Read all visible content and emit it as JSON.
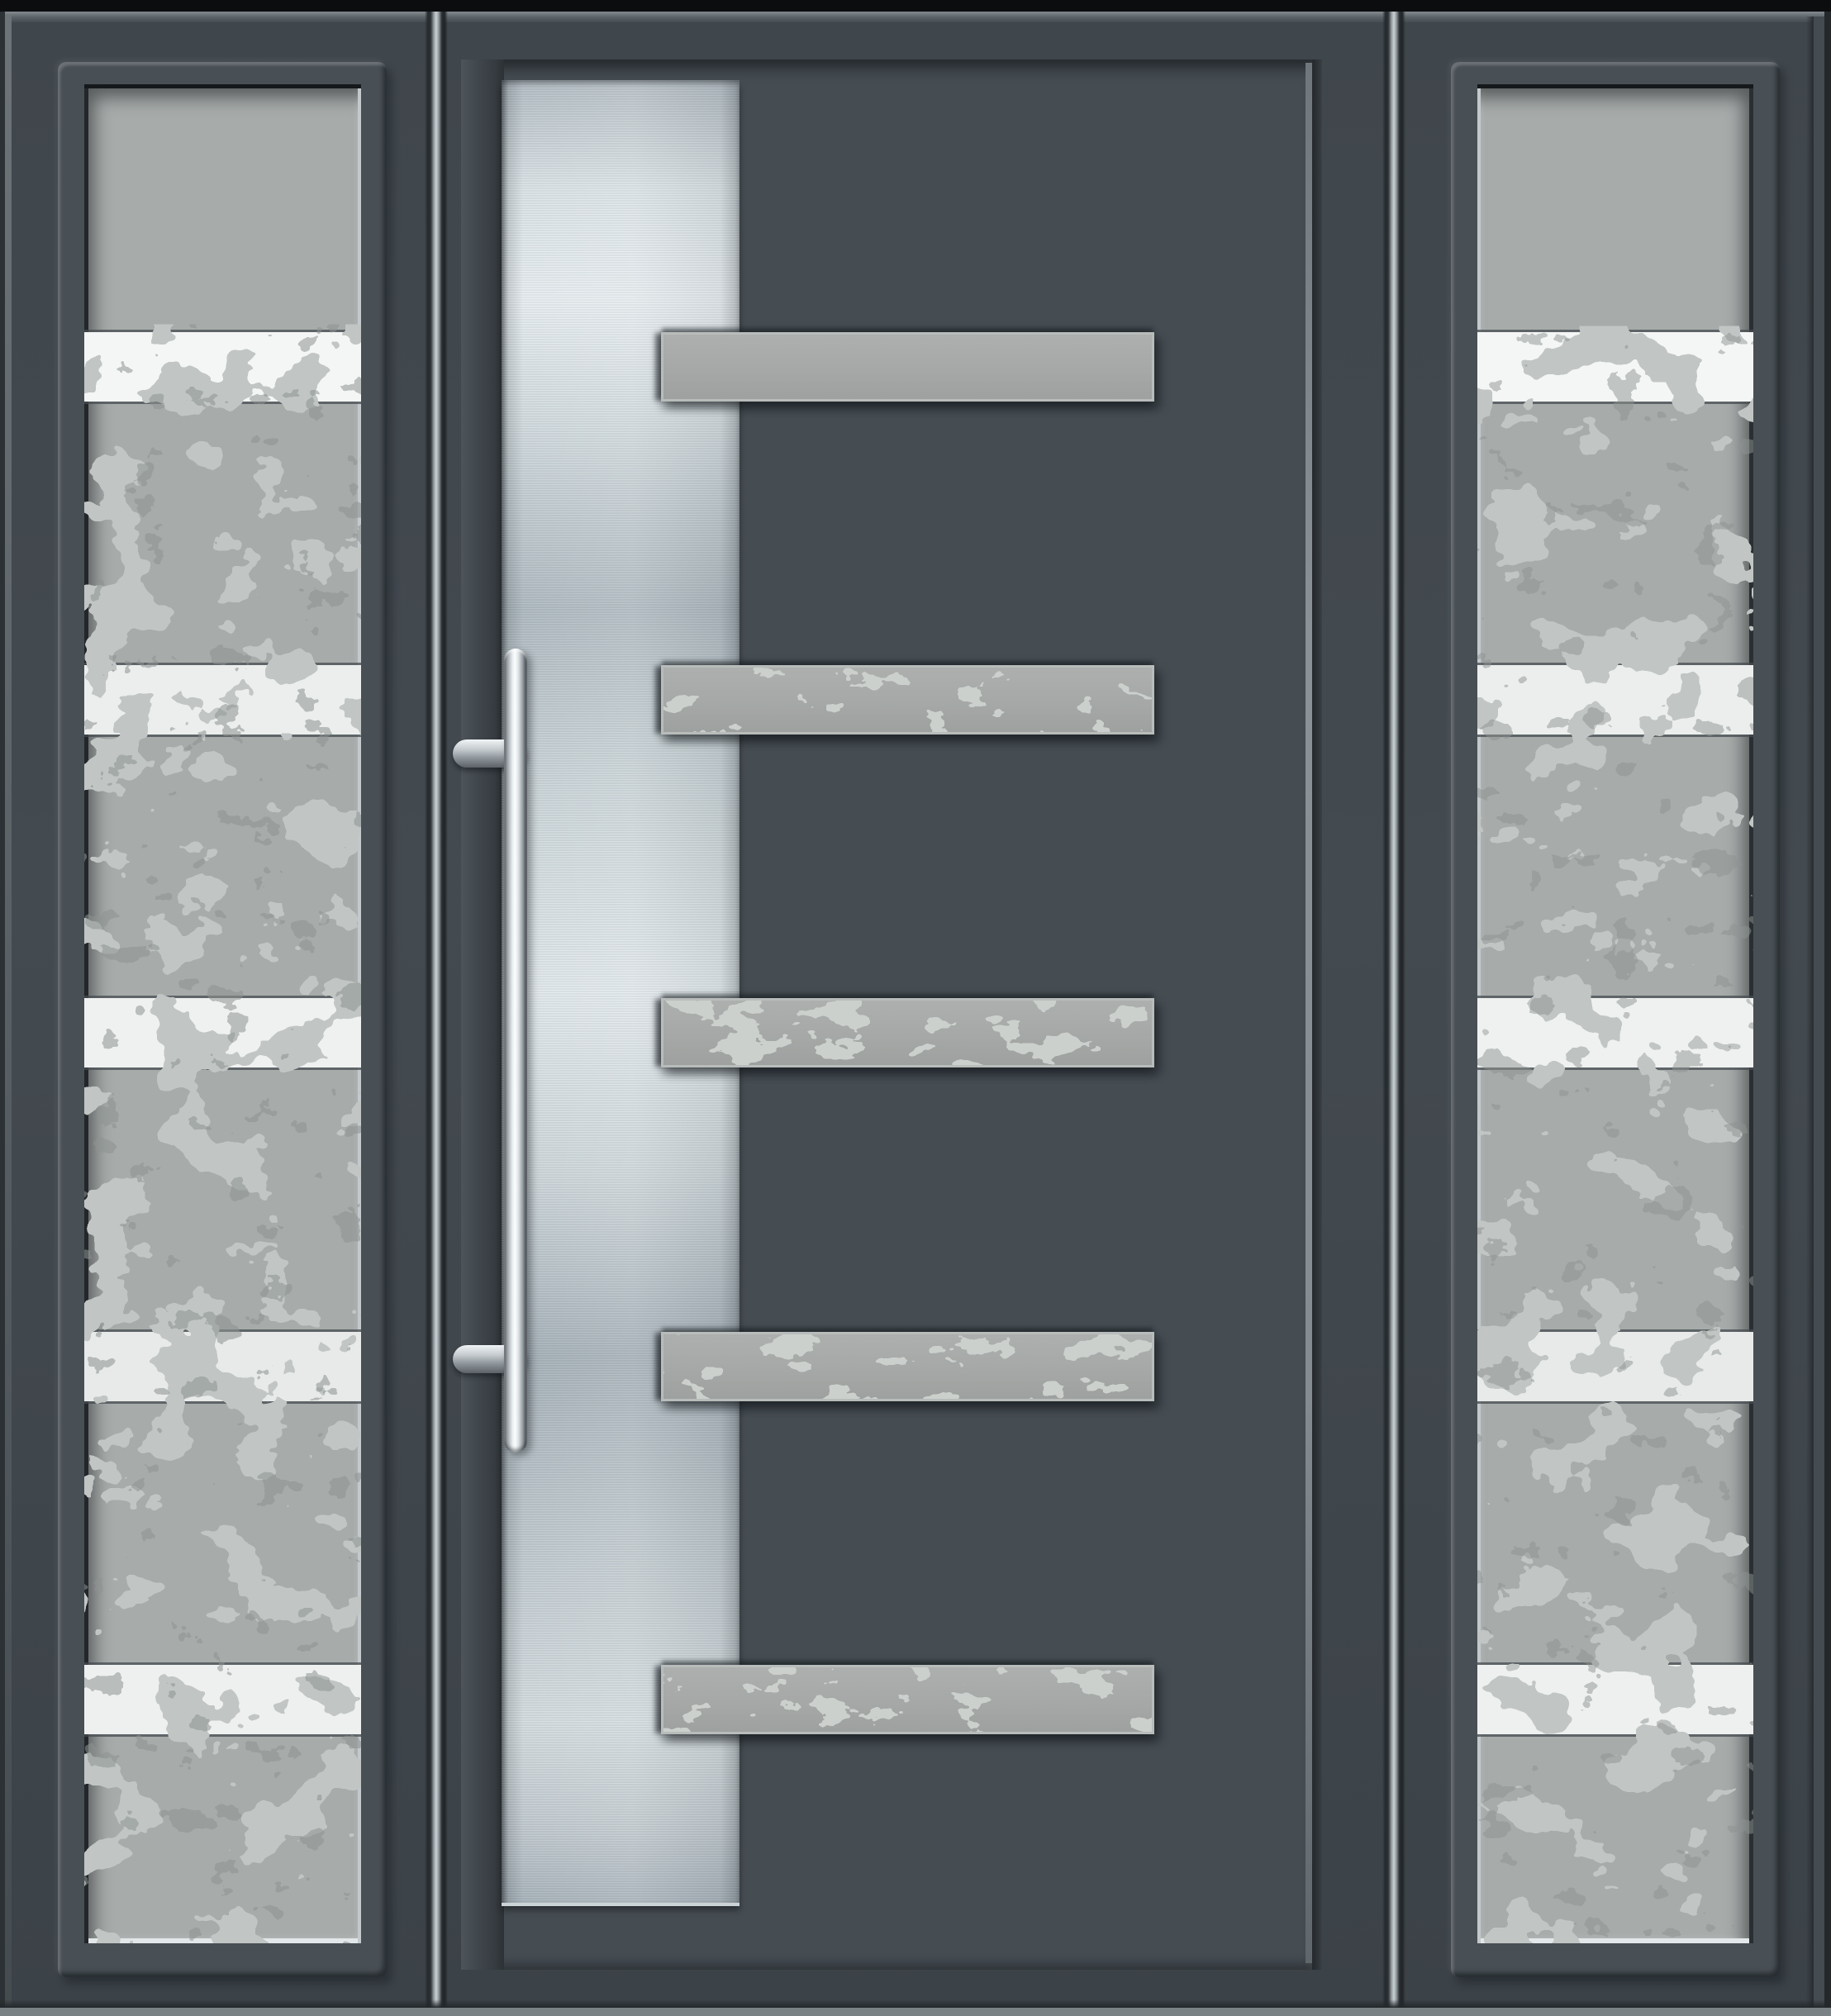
{
  "scene": {
    "subject": "Modern anthracite grey aluminium front entrance door with two fixed glazed sidelights",
    "view": "front elevation product render",
    "visible_text": ""
  },
  "palette": {
    "frame_anthracite": "#3f464c",
    "door_leaf": "#454c52",
    "deep_shadow": "#23272b",
    "edge_highlight": "#767e84",
    "top_strip_black": "#0b0d0f",
    "bottom_strip": "#7b8285",
    "glass_frosted": "#a7abaa",
    "glass_band_white": "#f4f6f5",
    "foliage_reflection": "#c1c6c4",
    "foliage_shadow": "#8e9492",
    "bar_speckle": "#cbd0cd",
    "glazing_bar": "#a5a8a6",
    "stainless_light": "#e9eff2",
    "stainless_mid": "#c2ccd1",
    "stainless_dark": "#8d979e",
    "handle_chrome_light": "#fcfefe",
    "handle_chrome_dark": "#5f666b"
  },
  "door": {
    "leaf_finish": "anthracite grey",
    "feature_panel": "vertical brushed stainless steel stripe",
    "glazing_strips_count": 5,
    "handle": "stainless steel vertical bar pull on two round mounts"
  },
  "sidelights": {
    "left": {
      "clear_bands_count": 5,
      "glazing": "frosted with tree reflections"
    },
    "right": {
      "clear_bands_count": 5,
      "glazing": "frosted with tree reflections"
    }
  }
}
